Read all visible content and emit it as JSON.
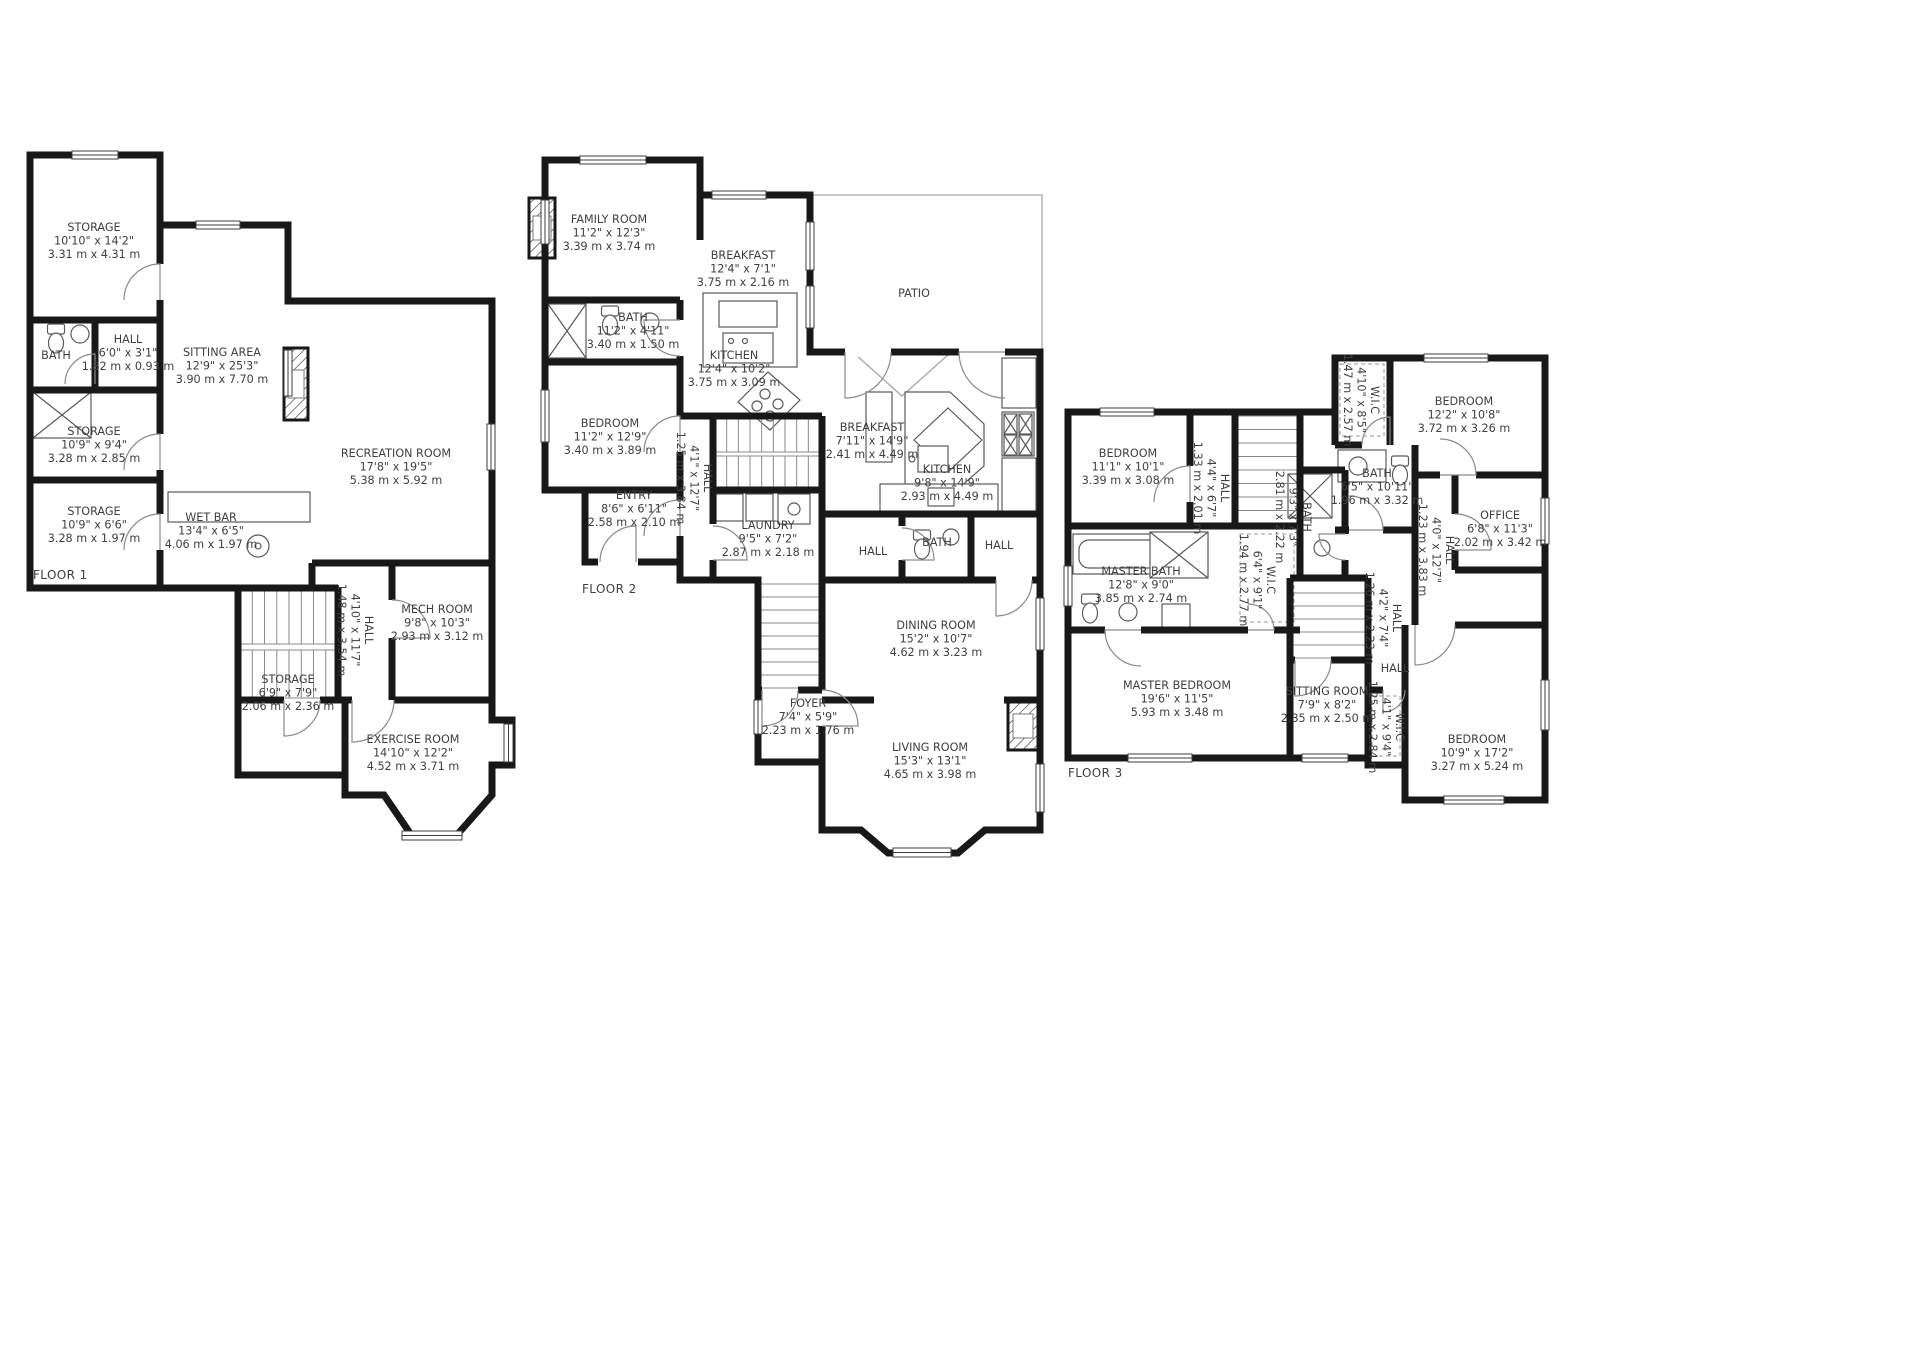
{
  "floors": [
    {
      "label": "FLOOR 1",
      "rooms": [
        {
          "id": "f1-storage-a",
          "name": "STORAGE",
          "ft": "10'10\" x 14'2\"",
          "m": "3.31 m x 4.31 m"
        },
        {
          "id": "f1-bath",
          "name": "BATH"
        },
        {
          "id": "f1-hall-a",
          "name": "HALL",
          "ft": "6'0\" x 3'1\"",
          "m": "1.82 m x 0.93 m"
        },
        {
          "id": "f1-sitting",
          "name": "SITTING AREA",
          "ft": "12'9\" x 25'3\"",
          "m": "3.90 m x 7.70 m"
        },
        {
          "id": "f1-storage-b",
          "name": "STORAGE",
          "ft": "10'9\" x 9'4\"",
          "m": "3.28 m x 2.85 m"
        },
        {
          "id": "f1-storage-c",
          "name": "STORAGE",
          "ft": "10'9\" x 6'6\"",
          "m": "3.28 m x 1.97 m"
        },
        {
          "id": "f1-recreation",
          "name": "RECREATION ROOM",
          "ft": "17'8\" x 19'5\"",
          "m": "5.38 m x 5.92 m"
        },
        {
          "id": "f1-wetbar",
          "name": "WET BAR",
          "ft": "13'4\" x 6'5\"",
          "m": "4.06 m x 1.97 m"
        },
        {
          "id": "f1-hall-b",
          "name": "HALL",
          "ft": "4'10\" x 11'7\"",
          "m": "1.48 m x 3.54 m",
          "vertical": true
        },
        {
          "id": "f1-mech",
          "name": "MECH ROOM",
          "ft": "9'8\" x 10'3\"",
          "m": "2.93 m x 3.12 m"
        },
        {
          "id": "f1-storage-d",
          "name": "STORAGE",
          "ft": "6'9\" x 7'9\"",
          "m": "2.06 m x 2.36 m"
        },
        {
          "id": "f1-exercise",
          "name": "EXERCISE ROOM",
          "ft": "14'10\" x 12'2\"",
          "m": "4.52 m x 3.71 m"
        }
      ]
    },
    {
      "label": "FLOOR 2",
      "rooms": [
        {
          "id": "f2-family",
          "name": "FAMILY ROOM",
          "ft": "11'2\" x 12'3\"",
          "m": "3.39 m x 3.74 m"
        },
        {
          "id": "f2-breakfast-a",
          "name": "BREAKFAST",
          "ft": "12'4\" x 7'1\"",
          "m": "3.75 m x 2.16 m"
        },
        {
          "id": "f2-patio",
          "name": "PATIO"
        },
        {
          "id": "f2-bath-a",
          "name": "BATH",
          "ft": "11'2\" x 4'11\"",
          "m": "3.40 m x 1.50 m"
        },
        {
          "id": "f2-kitchen-a",
          "name": "KITCHEN",
          "ft": "12'4\" x 10'2\"",
          "m": "3.75 m x 3.09 m"
        },
        {
          "id": "f2-bedroom",
          "name": "BEDROOM",
          "ft": "11'2\" x 12'9\"",
          "m": "3.40 m x 3.89 m"
        },
        {
          "id": "f2-breakfast-b",
          "name": "BREAKFAST",
          "ft": "7'11\" x 14'9\"",
          "m": "2.41 m x 4.49 m"
        },
        {
          "id": "f2-kitchen-b",
          "name": "KITCHEN",
          "ft": "9'8\" x 14'9\"",
          "m": "2.93 m x 4.49 m"
        },
        {
          "id": "f2-hall-v",
          "name": "HALL",
          "ft": "4'1\" x 12'7\"",
          "m": "1.25 m x 3.84 m",
          "vertical": true
        },
        {
          "id": "f2-entry",
          "name": "ENTRY",
          "ft": "8'6\" x 6'11\"",
          "m": "2.58 m x 2.10 m"
        },
        {
          "id": "f2-laundry",
          "name": "LAUNDRY",
          "ft": "9'5\" x 7'2\"",
          "m": "2.87 m x 2.18 m"
        },
        {
          "id": "f2-hall-a",
          "name": "HALL"
        },
        {
          "id": "f2-bath-b",
          "name": "BATH"
        },
        {
          "id": "f2-hall-b",
          "name": "HALL"
        },
        {
          "id": "f2-dining",
          "name": "DINING ROOM",
          "ft": "15'2\" x 10'7\"",
          "m": "4.62 m x 3.23 m"
        },
        {
          "id": "f2-foyer",
          "name": "FOYER",
          "ft": "7'4\" x 5'9\"",
          "m": "2.23 m x 1.76 m"
        },
        {
          "id": "f2-living",
          "name": "LIVING ROOM",
          "ft": "15'3\" x 13'1\"",
          "m": "4.65 m x 3.98 m"
        }
      ]
    },
    {
      "label": "FLOOR 3",
      "rooms": [
        {
          "id": "f3-bedroom-a",
          "name": "BEDROOM",
          "ft": "11'1\" x 10'1\"",
          "m": "3.39 m x 3.08 m"
        },
        {
          "id": "f3-wic-a",
          "name": "W.I.C",
          "ft": "4'10\" x 8'5\"",
          "m": "1.47 m x 2.57 m",
          "vertical": true
        },
        {
          "id": "f3-bedroom-b",
          "name": "BEDROOM",
          "ft": "12'2\" x 10'8\"",
          "m": "3.72 m x 3.26 m"
        },
        {
          "id": "f3-hall-a",
          "name": "HALL",
          "ft": "4'4\" x 6'7\"",
          "m": "1.33 m x 2.01 m",
          "vertical": true
        },
        {
          "id": "f3-bath-a",
          "name": "BATH",
          "ft": "6'5\" x 10'11\"",
          "m": "1.96 m x 3.32 m"
        },
        {
          "id": "f3-bath-b",
          "name": "BATH",
          "ft": "9'3\" x 7'3\"",
          "m": "2.81 m x 2.22 m",
          "vertical": true
        },
        {
          "id": "f3-office",
          "name": "OFFICE",
          "ft": "6'8\" x 11'3\"",
          "m": "2.02 m x 3.42 m"
        },
        {
          "id": "f3-hall-b",
          "name": "HALL",
          "ft": "4'0\" x 12'7\"",
          "m": "1.23 m x 3.83 m",
          "vertical": true
        },
        {
          "id": "f3-wic-b",
          "name": "W.I.C",
          "ft": "6'4\" x 9'1\"",
          "m": "1.94 m x 2.77 m",
          "vertical": true
        },
        {
          "id": "f3-master-bath",
          "name": "MASTER BATH",
          "ft": "12'8\" x 9'0\"",
          "m": "3.85 m x 2.74 m"
        },
        {
          "id": "f3-hall-c",
          "name": "HALL",
          "ft": "4'2\" x 7'4\"",
          "m": "1.26 m x 2.23 m",
          "vertical": true
        },
        {
          "id": "f3-hall-d",
          "name": "HALL"
        },
        {
          "id": "f3-master-bedroom",
          "name": "MASTER BEDROOM",
          "ft": "19'6\" x 11'5\"",
          "m": "5.93 m x 3.48 m"
        },
        {
          "id": "f3-sitting",
          "name": "SITTING ROOM",
          "ft": "7'9\" x 8'2\"",
          "m": "2.35 m x 2.50 m"
        },
        {
          "id": "f3-wic-c",
          "name": "W.I.C",
          "ft": "4'1\" x 9'4\"",
          "m": "1.25 m x 2.84 m",
          "vertical": true
        },
        {
          "id": "f3-bedroom-c",
          "name": "BEDROOM",
          "ft": "10'9\" x 17'2\"",
          "m": "3.27 m x 5.24 m"
        }
      ]
    }
  ]
}
